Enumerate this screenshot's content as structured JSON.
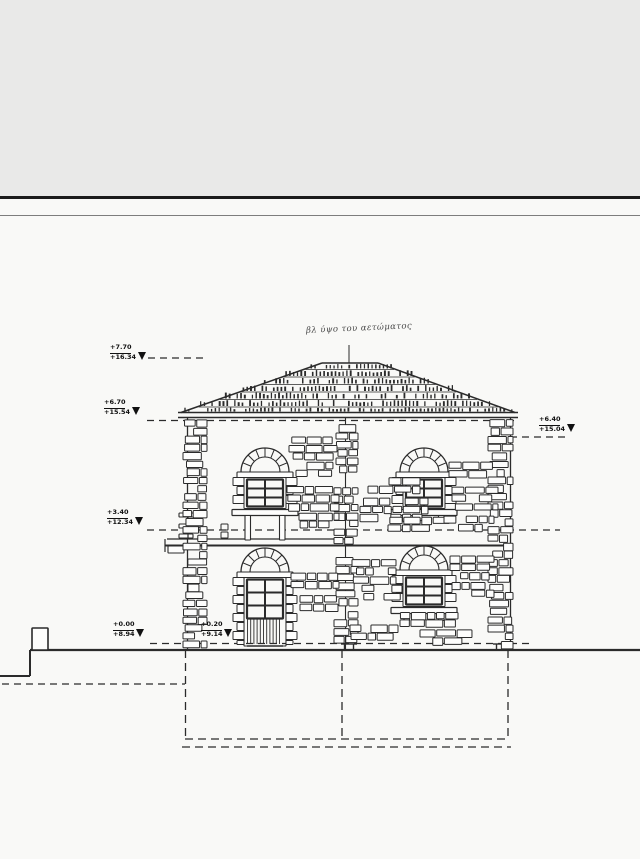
{
  "annotation": {
    "note": "βλ ύψο του αετώματος"
  },
  "markers": {
    "ridge": {
      "upper": "+7.70",
      "lower": "+16.34"
    },
    "eave_left": {
      "upper": "+6.70",
      "lower": "+15.54"
    },
    "mid_floor": {
      "upper": "+3.40",
      "lower": "+12.34"
    },
    "eave_right": {
      "upper": "+6.40",
      "lower": "+15.04"
    },
    "ground": {
      "upper": "+0.00",
      "lower": "+8.94"
    },
    "threshold": {
      "upper": "+0.20",
      "lower": "+9.14"
    }
  },
  "colors": {
    "paper": "#f9f9f7",
    "scan_band": "#e9e9e8",
    "ink": "#2b2b2b",
    "edge_line": "#1b1b1b"
  }
}
